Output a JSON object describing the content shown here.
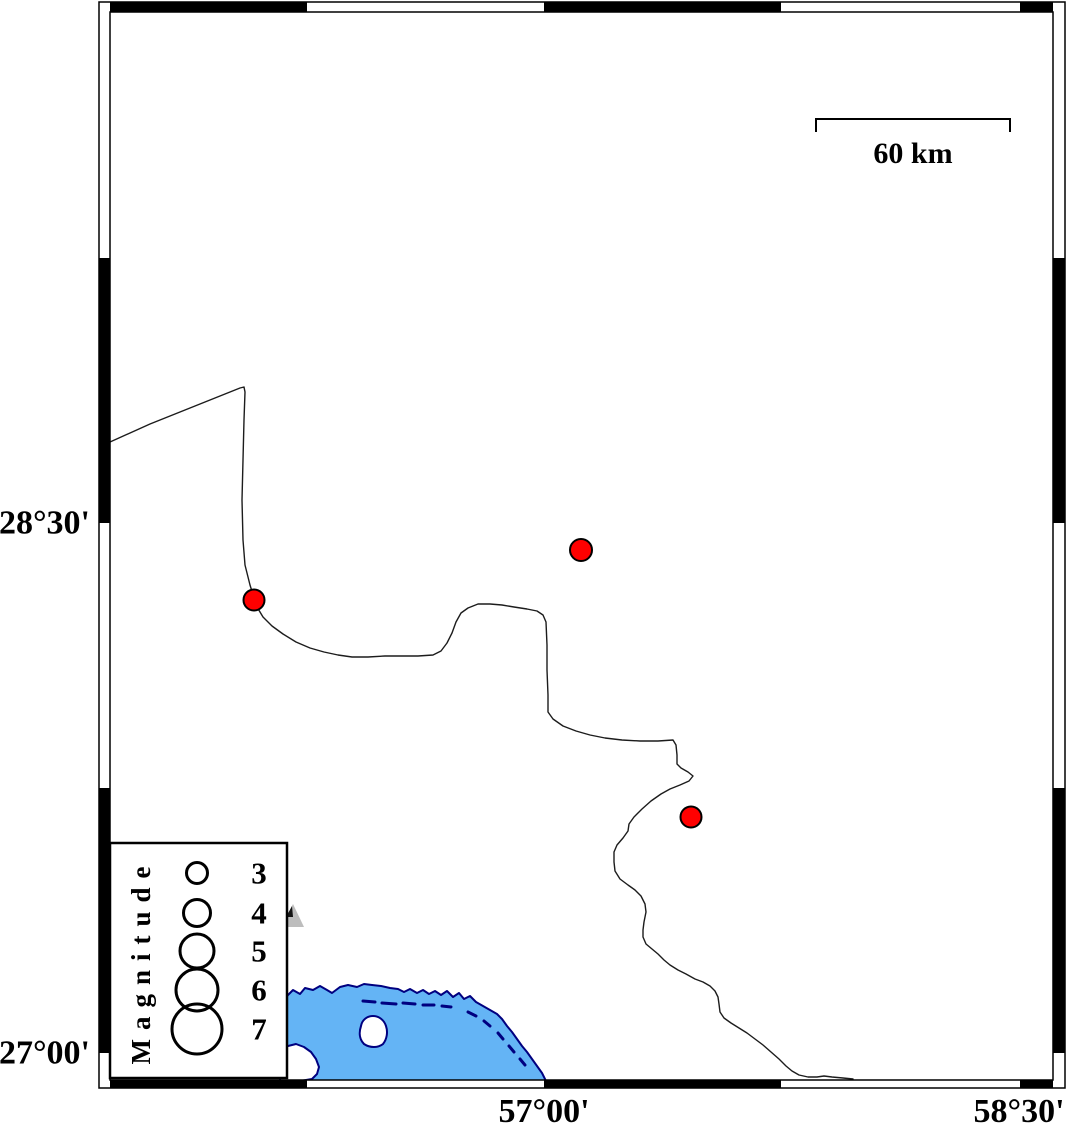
{
  "map": {
    "kind": "seismicity-map",
    "region_note": "frame alternates every 45 arc-minutes"
  },
  "axis": {
    "left_labels": [
      {
        "text": "28°30'",
        "y": 523
      },
      {
        "text": "27°00'",
        "y": 1053
      }
    ],
    "bottom_labels": [
      {
        "text": "57°00'",
        "x": 544
      },
      {
        "text": "58°30'",
        "x": 1019
      }
    ]
  },
  "scale_bar": {
    "label": "60 km"
  },
  "legend": {
    "title": "Magnitude",
    "items": [
      {
        "label": "3",
        "r": 10.5,
        "cy": 873
      },
      {
        "label": "4",
        "r": 13.5,
        "cy": 913
      },
      {
        "label": "5",
        "r": 17,
        "cy": 951
      },
      {
        "label": "6",
        "r": 21,
        "cy": 990
      },
      {
        "label": "7",
        "r": 25,
        "cy": 1029
      }
    ]
  },
  "epicenters": [
    {
      "x": 581,
      "y": 550,
      "r": 11,
      "approx_lon": "57°07'",
      "approx_lat": "28°25'"
    },
    {
      "x": 254,
      "y": 600,
      "r": 10.5,
      "approx_lon": "56°05'",
      "approx_lat": "28°17'"
    },
    {
      "x": 691,
      "y": 817,
      "r": 10.5,
      "approx_lon": "57°28'",
      "approx_lat": "27°40'"
    }
  ],
  "colors": {
    "epicenter": "#ff0000",
    "sea": "#64b4f5",
    "coastline": "#000080",
    "land": "#ffffff",
    "frame": "#000000",
    "boundary": "#1c1c1c",
    "triangle": "#bdbdbd"
  }
}
